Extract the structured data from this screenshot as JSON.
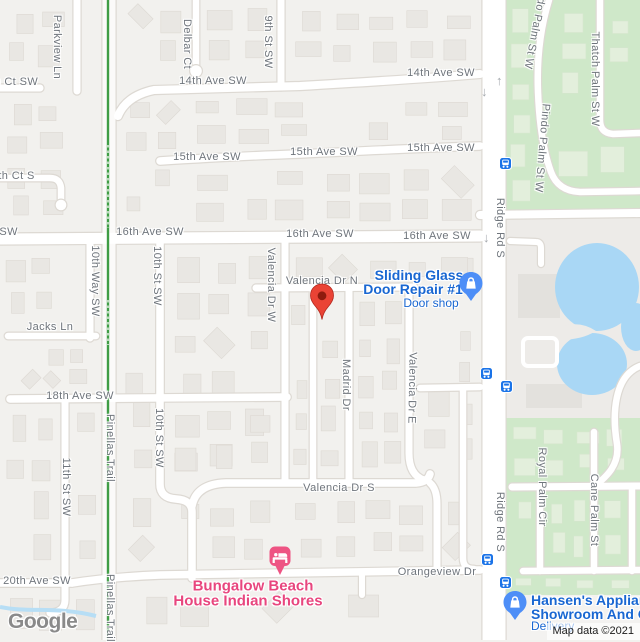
{
  "map": {
    "logo": "Google",
    "attribution": "Map data ©2021",
    "colors": {
      "label_gray": "#6f757c",
      "poi_blue": "#1967d2",
      "poi_pink": "#e8467e",
      "pin_blue": "#4d8ef7",
      "pin_pink": "#ee5483",
      "bus_blue": "#1a73e8",
      "marker_red": "#ea4335",
      "green_area": "#cfe8c9",
      "water": "#a9d7f5",
      "trail_green": "#3f9d45"
    },
    "street_labels": [
      {
        "text": "14th Ct SW",
        "x": 8,
        "y": 82,
        "r": 0
      },
      {
        "text": "15th Ct S",
        "x": 10,
        "y": 176,
        "r": 0
      },
      {
        "text": "14th Ave SW",
        "x": 213,
        "y": 81,
        "r": 0
      },
      {
        "text": "14th Ave SW",
        "x": 441,
        "y": 73,
        "r": 0
      },
      {
        "text": "15th Ave SW",
        "x": 207,
        "y": 157,
        "r": 0
      },
      {
        "text": "15th Ave SW",
        "x": 324,
        "y": 152,
        "r": 0
      },
      {
        "text": "15th Ave SW",
        "x": 441,
        "y": 148,
        "r": 0
      },
      {
        "text": "16th Ave SW",
        "x": -16,
        "y": 232,
        "r": 0
      },
      {
        "text": "16th Ave SW",
        "x": 150,
        "y": 232,
        "r": 0
      },
      {
        "text": "16th Ave SW",
        "x": 320,
        "y": 234,
        "r": 0
      },
      {
        "text": "16th Ave SW",
        "x": 437,
        "y": 236,
        "r": 0
      },
      {
        "text": "Valencia Dr N",
        "x": 322,
        "y": 281,
        "r": 0
      },
      {
        "text": "Jacks Ln",
        "x": 50,
        "y": 327,
        "r": 0
      },
      {
        "text": "18th Ave SW",
        "x": 80,
        "y": 396,
        "r": 0
      },
      {
        "text": "Valencia Dr S",
        "x": 339,
        "y": 488,
        "r": 0
      },
      {
        "text": "20th Ave SW",
        "x": 37,
        "y": 581,
        "r": 0
      },
      {
        "text": "Orangeview Dr",
        "x": 437,
        "y": 572,
        "r": 0
      },
      {
        "text": "Parkview Ln",
        "x": 57,
        "y": 47,
        "r": 90
      },
      {
        "text": "Delbar Ct",
        "x": 187,
        "y": 44,
        "r": 90
      },
      {
        "text": "9th St SW",
        "x": 268,
        "y": 42,
        "r": 90
      },
      {
        "text": "10th Way SW",
        "x": 95,
        "y": 281,
        "r": 90
      },
      {
        "text": "10th St SW",
        "x": 157,
        "y": 276,
        "r": 90
      },
      {
        "text": "10th St SW",
        "x": 159,
        "y": 438,
        "r": 90
      },
      {
        "text": "11th St SW",
        "x": 66,
        "y": 487,
        "r": 90
      },
      {
        "text": "Pinellas Trail",
        "x": 110,
        "y": 448,
        "r": 90
      },
      {
        "text": "Pinellas Trail",
        "x": 110,
        "y": 608,
        "r": 90
      },
      {
        "text": "Valencia Dr W",
        "x": 271,
        "y": 285,
        "r": 90
      },
      {
        "text": "Madrid Dr",
        "x": 346,
        "y": 385,
        "r": 90
      },
      {
        "text": "Valencia Dr E",
        "x": 412,
        "y": 388,
        "r": 91
      },
      {
        "text": "Ridge Rd S",
        "x": 500,
        "y": 228,
        "r": 90
      },
      {
        "text": "Ridge Rd S",
        "x": 500,
        "y": 522,
        "r": 90
      },
      {
        "text": "Pindo Palm St W",
        "x": 536,
        "y": 25,
        "r": 101
      },
      {
        "text": "Pindo Palm St W",
        "x": 542,
        "y": 148,
        "r": 95
      },
      {
        "text": "Thatch Palm St W",
        "x": 595,
        "y": 79,
        "r": 90
      },
      {
        "text": "Royal Palm Cir",
        "x": 542,
        "y": 487,
        "r": 90
      },
      {
        "text": "Cane Palm St",
        "x": 594,
        "y": 510,
        "r": 90
      }
    ],
    "pois": [
      {
        "id": "sliding-glass-door-repair",
        "color": "#1967d2",
        "lines": [
          {
            "text": "Sliding Glass",
            "x": 419,
            "y": 275,
            "size": 14
          },
          {
            "text": "Door Repair #1",
            "x": 413,
            "y": 289,
            "size": 14
          }
        ],
        "sub": {
          "text": "Door shop",
          "x": 431,
          "y": 303,
          "size": 12
        },
        "pin": {
          "type": "shop",
          "x": 471,
          "y": 283
        }
      },
      {
        "id": "bungalow-beach-house",
        "color": "#e8467e",
        "lines": [
          {
            "text": "Bungalow Beach",
            "x": 253,
            "y": 586,
            "size": 15
          },
          {
            "text": "House Indian Shores",
            "x": 248,
            "y": 601,
            "size": 15
          }
        ],
        "pin": {
          "type": "lodging",
          "x": 281,
          "y": 557
        }
      },
      {
        "id": "hansens-appliance",
        "color": "#1967d2",
        "align": "left",
        "lines": [
          {
            "text": "Hansen's Applianc",
            "x": 531,
            "y": 600,
            "size": 14
          },
          {
            "text": "Showroom And Ou",
            "x": 531,
            "y": 614,
            "size": 14
          }
        ],
        "sub": {
          "text": "Delivery",
          "x": 531,
          "y": 626,
          "size": 12
        },
        "pin": {
          "type": "shop",
          "x": 515,
          "y": 602
        }
      }
    ],
    "destination_marker": {
      "x": 322,
      "y": 320
    },
    "bus_stops": [
      {
        "x": 505,
        "y": 163
      },
      {
        "x": 486,
        "y": 373
      },
      {
        "x": 506,
        "y": 386
      },
      {
        "x": 487,
        "y": 559
      },
      {
        "x": 505,
        "y": 582
      }
    ],
    "one_way_arrows": [
      {
        "x": 501,
        "y": 81,
        "dir": "up"
      },
      {
        "x": 486,
        "y": 92,
        "dir": "down"
      },
      {
        "x": 488,
        "y": 238,
        "dir": "down"
      }
    ]
  }
}
